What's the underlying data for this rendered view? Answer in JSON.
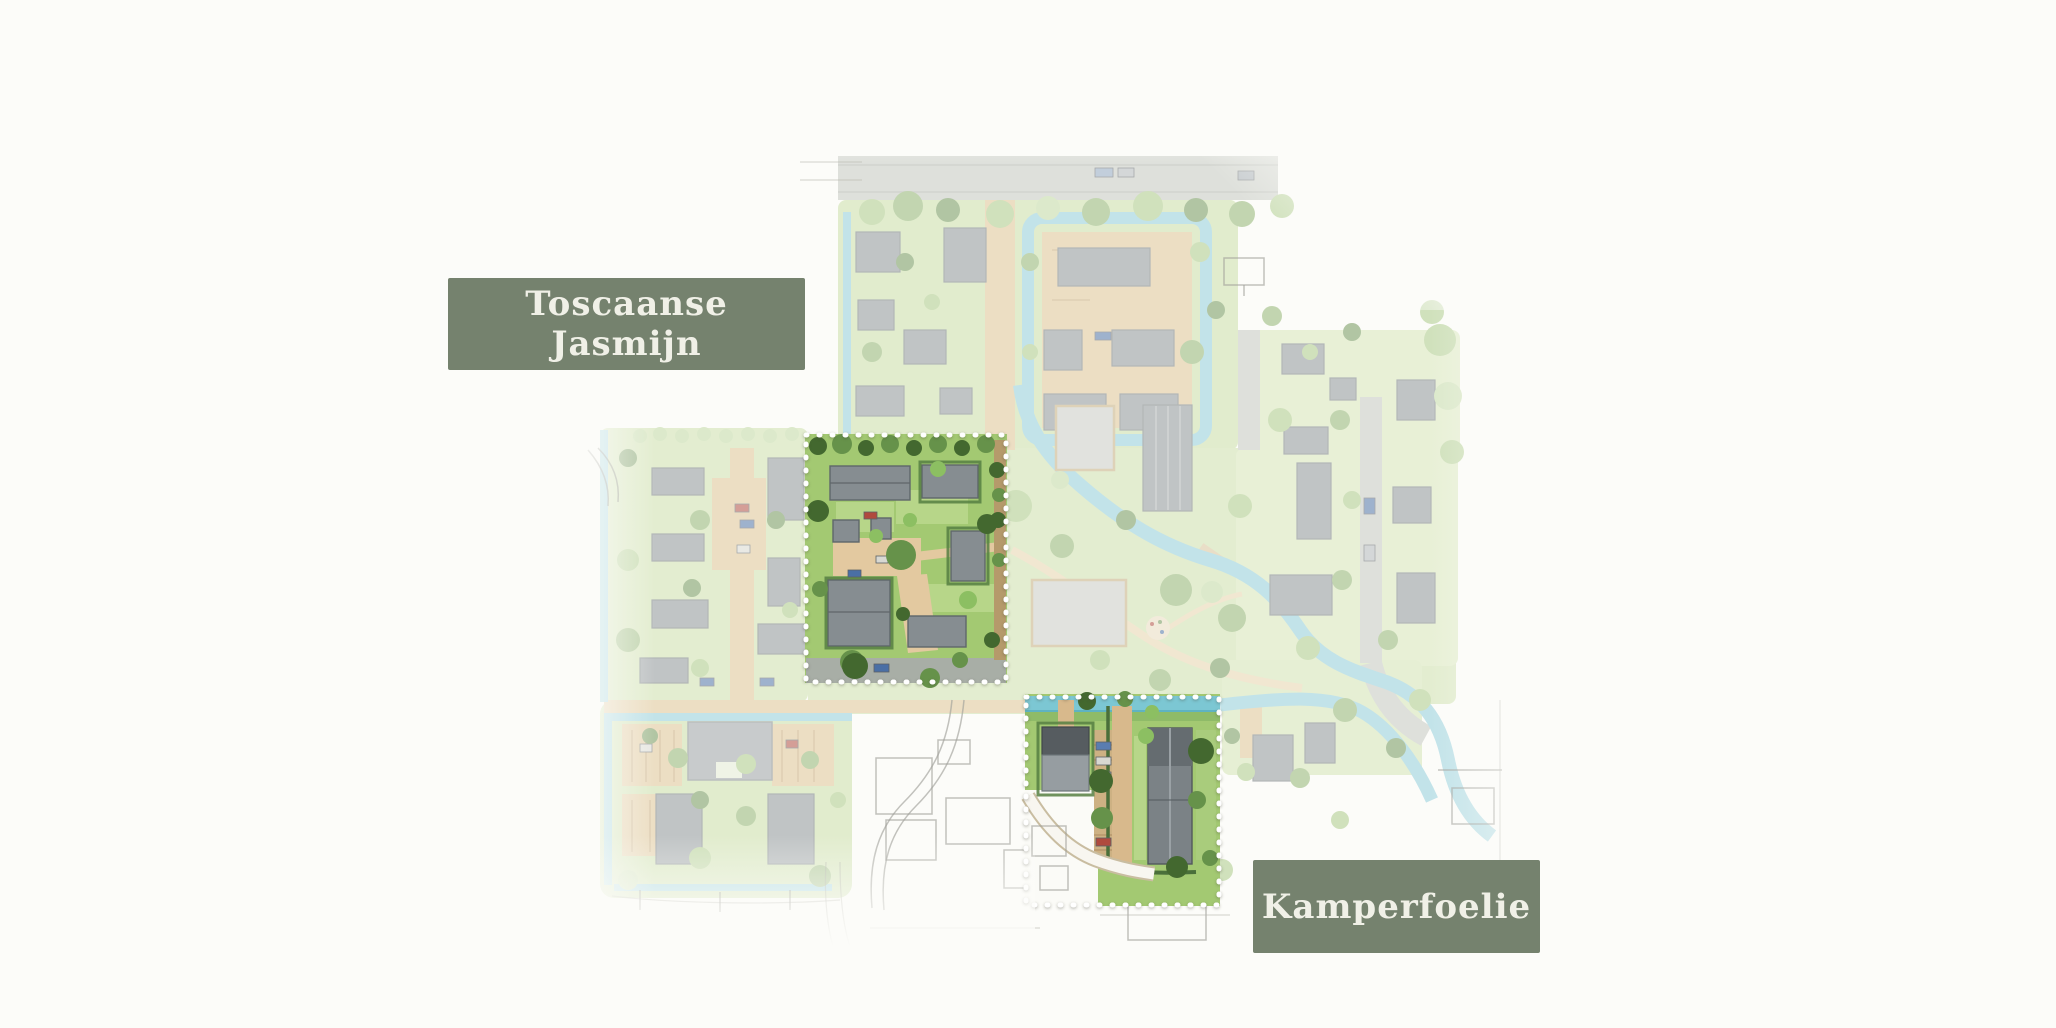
{
  "page": {
    "background_color": "#fcfcf9"
  },
  "site_plan": {
    "plots": [
      {
        "id": "toscaanse-jasmijn",
        "label": "Toscaanse Jasmijn",
        "highlighted": true
      },
      {
        "id": "kamperfoelie",
        "label": "Kamperfoelie",
        "highlighted": true
      }
    ],
    "colors": {
      "label_background": "#75826e",
      "label_text": "#f0f0e7",
      "highlight_border": "#ffffff",
      "water": "#8fcddc",
      "grass_highlight": "#a3c972",
      "grass_faded": "#cde1ab",
      "road_tan": "#dfc493",
      "building_gray": "#868d91"
    }
  }
}
